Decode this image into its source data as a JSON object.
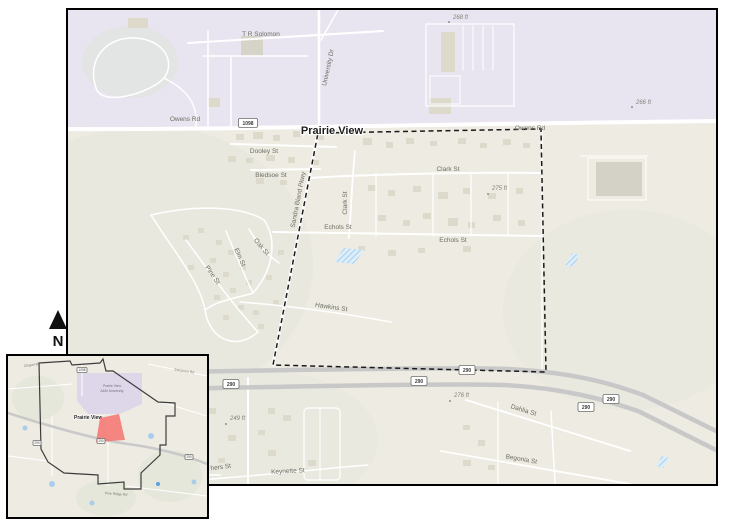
{
  "north_arrow": {
    "label": "N"
  },
  "colors": {
    "land": "#edebe2",
    "campus_purple": "#e8e4f0",
    "inset_campus_purple": "#ded7ea",
    "highway_gray": "#c8c8c8",
    "water_blue": "#d7e9f8",
    "study_area_red": "#f4736e",
    "boundary_dash": "#1a1a1a"
  },
  "main_map": {
    "city_label": "Prairie View",
    "street_labels": [
      "T R Solomon",
      "University Dr",
      "Owens Rd",
      "Owens Rd",
      "Dooley St",
      "Bledsoe St",
      "Sandra Bland Pkwy",
      "Clark St",
      "Clark St",
      "Echols St",
      "Echols St",
      "Elm St",
      "Oak St",
      "Pine St",
      "Hawkins St",
      "Dahlia St",
      "Begonia St",
      "Keynette St",
      "hers St"
    ],
    "elevation_labels": [
      "268 ft",
      "266 ft",
      "275 ft",
      "276 ft",
      "249 ft"
    ],
    "route_shields": [
      "1098",
      "290",
      "290",
      "290",
      "290",
      "290"
    ]
  },
  "inset_map": {
    "campus_label_line1": "Prairie View",
    "campus_label_line2": "A&M University",
    "city_label": "Prairie View",
    "road_labels": [
      "Chapel Rd",
      "Sampson Rd",
      "Pine Ridge Rd"
    ],
    "route_shields": [
      "1098",
      "290",
      "290",
      "290"
    ]
  }
}
